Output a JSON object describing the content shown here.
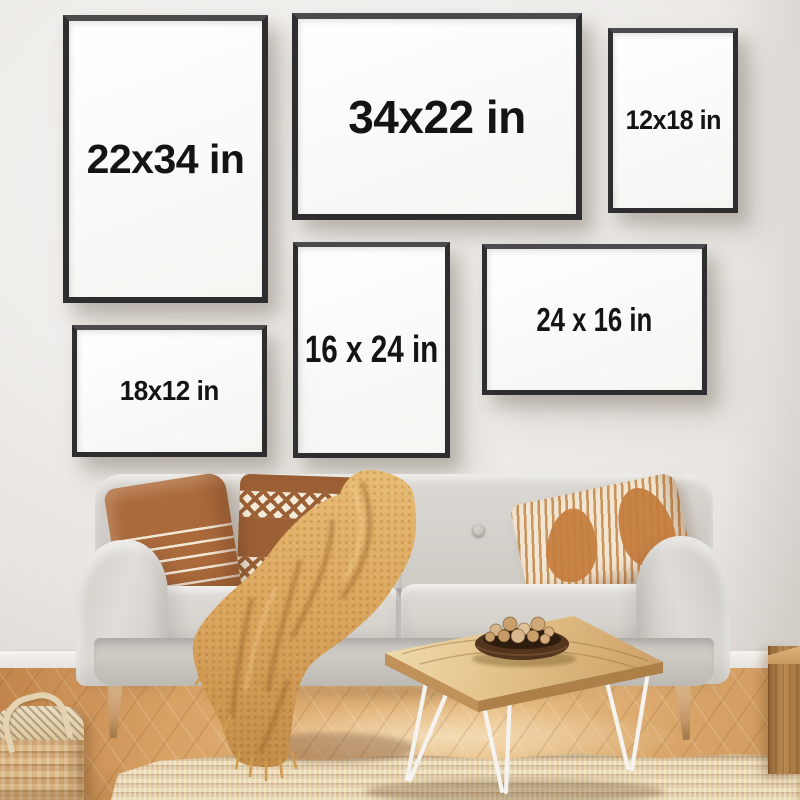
{
  "scene": {
    "description": "Living-room wall art size mockup: six framed poster sizes above a sofa",
    "palette": {
      "wall": "#efedeb",
      "frame_border": "#2e2e30",
      "frame_mat": "#fdfdfd",
      "label_text": "#141414",
      "sofa": "#d7d4cf",
      "blanket": "#d9a45c",
      "pillow_caramel": "#ab6a3c",
      "wood_floor": "#d9a76e",
      "table_wood": "#e3c38c",
      "rug": "#e2d0ab"
    }
  },
  "frames": [
    {
      "label": "22x34 in",
      "orientation": "portrait",
      "position": "top-left"
    },
    {
      "label": "34x22 in",
      "orientation": "landscape",
      "position": "top-center"
    },
    {
      "label": "12x18 in",
      "orientation": "portrait",
      "position": "top-right"
    },
    {
      "label": "16 x 24 in",
      "orientation": "portrait",
      "position": "middle-center"
    },
    {
      "label": "24 x 16 in",
      "orientation": "landscape",
      "position": "middle-right"
    },
    {
      "label": "18x12 in",
      "orientation": "landscape",
      "position": "middle-left"
    }
  ]
}
